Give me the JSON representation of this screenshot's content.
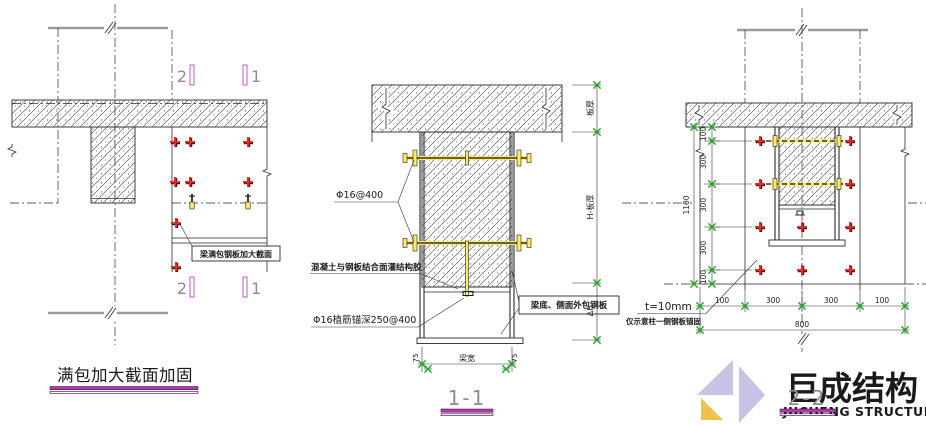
{
  "drawing_left": {
    "title": "满包加大截面加固",
    "callout": "梁满包钢板加大截面",
    "section_markers": {
      "top_left": "2",
      "top_right": "1",
      "bottom_left": "2",
      "bottom_right": "1"
    }
  },
  "drawing_middle": {
    "title": "1-1",
    "labels": {
      "bolts": "Φ16@400",
      "adhesive": "混凝土与钢板结合面灌结构胶",
      "rebar": "Φ16植筋锚深250@400",
      "plate_box": "梁底、侧面外包钢板"
    },
    "dims": {
      "slab": "板厚",
      "web": "H-板厚",
      "delta": "Δh",
      "width": "梁宽",
      "offset_left": "75",
      "offset_right": "75"
    }
  },
  "drawing_right": {
    "title": "2-2",
    "labels": {
      "thickness": "t=10mm",
      "note": "仅示意柱一侧钢板锚固"
    },
    "dims": {
      "left_segments": [
        "100",
        "300",
        "300",
        "300",
        "100"
      ],
      "left_total": "1100",
      "bottom_segments": [
        "100",
        "300",
        "300",
        "100"
      ],
      "bottom_total": "800"
    }
  },
  "logo": {
    "name_cn": "巨成结构",
    "name_en": "JUCHENG STRUCTURE"
  },
  "colors": {
    "accent_magenta": "#B13AB1",
    "anchor_red": "#D93025",
    "bolt_yellow": "#FFE96B",
    "marker_green": "#2F9E2F",
    "cut_line_grey": "#9B9B9B",
    "logo_lavender": "#C8C2E4",
    "logo_yellow": "#F0C24B"
  }
}
